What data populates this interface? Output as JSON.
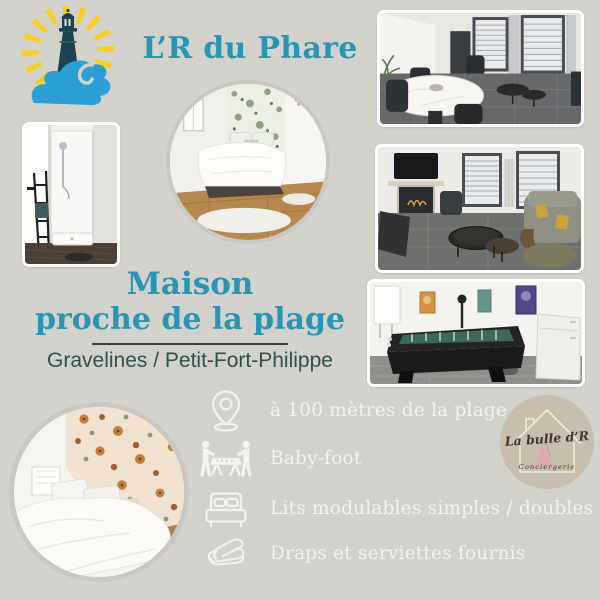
{
  "poster": {
    "background_color": "#d3d1cc",
    "accent_color": "#2795b3",
    "feature_text_color": "#f4f2ec"
  },
  "brand": {
    "title": "L’R du Phare",
    "logo": {
      "icon": "lighthouse-icon",
      "rays_color": "#f6cf25",
      "tower_color": "#1c4250",
      "wave_color": "#2b9fd4"
    }
  },
  "headline": {
    "line1": "Maison",
    "line2": "proche de la plage",
    "location": "Gravelines / Petit-Fort-Philippe",
    "location_color": "#30504c"
  },
  "features": {
    "items": [
      {
        "icon": "map-pin-icon",
        "label": "à 100 mètres de la plage"
      },
      {
        "icon": "foosball-players-icon",
        "label": "Baby-foot"
      },
      {
        "icon": "double-bed-icon",
        "label": "Lits modulables simples / doubles"
      },
      {
        "icon": "folded-linens-icon",
        "label": "Draps et serviettes fournis"
      }
    ]
  },
  "agency_badge": {
    "name": "La bulle d’R",
    "tagline": "Conciergerie",
    "badge_color": "#c8beac",
    "icon": "house-outline-icon"
  },
  "photos": [
    {
      "name": "photo-dining-room"
    },
    {
      "name": "photo-shower-room"
    },
    {
      "name": "photo-bedroom-green-floral"
    },
    {
      "name": "photo-living-room"
    },
    {
      "name": "photo-games-room"
    },
    {
      "name": "photo-bedroom-floral"
    }
  ]
}
